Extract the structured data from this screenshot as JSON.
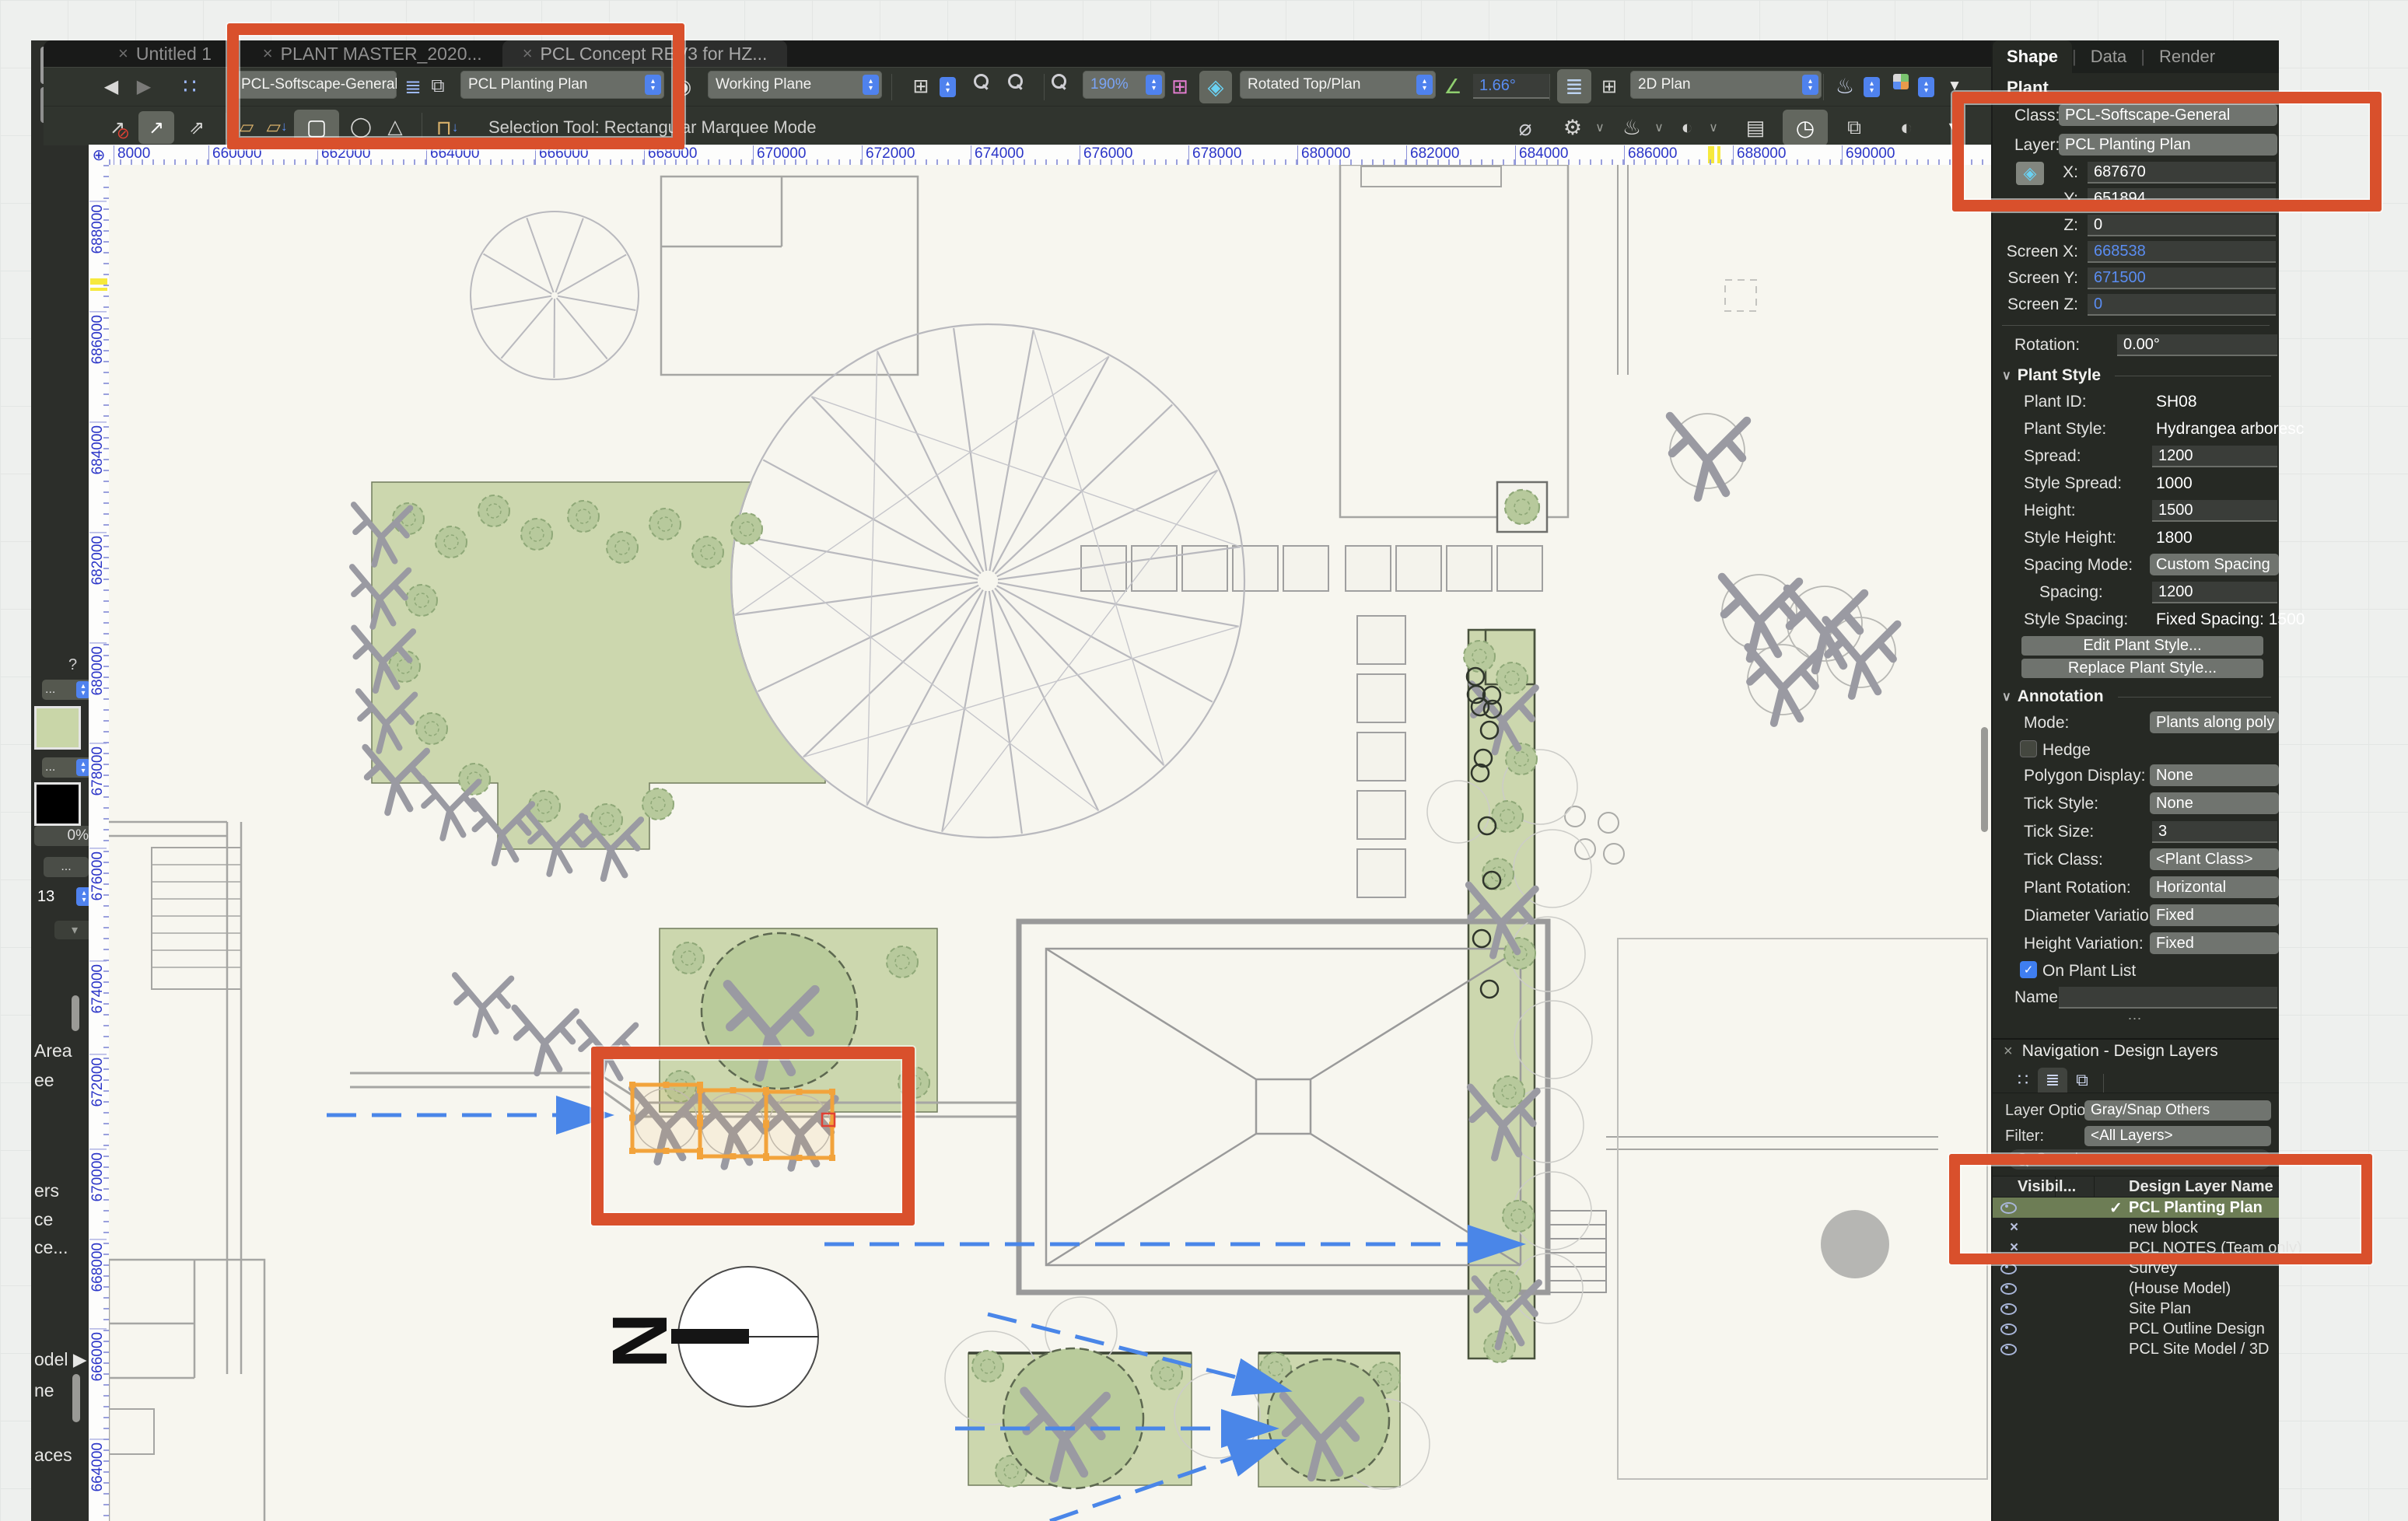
{
  "titlebar": {
    "tabs": [
      {
        "title": "Untitled 1",
        "active": false
      },
      {
        "title": "PLANT MASTER_2020...",
        "active": false
      },
      {
        "title": "PCL Concept REV3 for HZ...",
        "active": true
      }
    ]
  },
  "toolbar": {
    "class_value": "PCL-Softscape-General",
    "layer_value": "PCL Planting Plan",
    "plane_value": "Working Plane",
    "zoom_value": "190%",
    "view_value": "Rotated Top/Plan",
    "angle_value": "1.66°",
    "plan_value": "2D Plan"
  },
  "modebar": {
    "status": "Selection Tool: Rectangular Marquee Mode"
  },
  "rulers": {
    "horizontal": [
      "8000",
      "660000",
      "662000",
      "664000",
      "666000",
      "668000",
      "670000",
      "672000",
      "674000",
      "676000",
      "678000",
      "680000",
      "682000",
      "684000",
      "686000",
      "688000",
      "690000"
    ],
    "vertical": [
      "688000",
      "686000",
      "684000",
      "682000",
      "680000",
      "678000",
      "676000",
      "674000",
      "672000",
      "670000",
      "668000",
      "666000",
      "664000"
    ]
  },
  "attributes_panel": {
    "help": "?",
    "dots": "...",
    "opacity": "0%",
    "line_weight": "13",
    "flat_arrow": "▾"
  },
  "left_fragments": [
    "Area",
    "ee",
    "ers",
    "ce",
    "ce...",
    "odel ▶",
    "ne",
    "aces"
  ],
  "canvas": {
    "north_label": "N"
  },
  "object_info": {
    "tabs": [
      "Shape",
      "Data",
      "Render"
    ],
    "object_type": "Plant",
    "class_label": "Class:",
    "class_value": "PCL-Softscape-General",
    "layer_label": "Layer:",
    "layer_value": "PCL Planting Plan",
    "coord_fields": [
      {
        "label": "X:",
        "value": "687670",
        "blue": false
      },
      {
        "label": "Y:",
        "value": "651894",
        "blue": false
      },
      {
        "label": "Z:",
        "value": "0",
        "blue": false
      },
      {
        "label": "Screen X:",
        "value": "668538",
        "blue": true
      },
      {
        "label": "Screen Y:",
        "value": "671500",
        "blue": true
      },
      {
        "label": "Screen Z:",
        "value": "0",
        "blue": true
      }
    ],
    "rotation_label": "Rotation:",
    "rotation_value": "0.00°",
    "plant_style_header": "Plant Style",
    "plant_style_rows": [
      {
        "label": "Plant ID:",
        "value": "SH08",
        "type": "text"
      },
      {
        "label": "Plant Style:",
        "value": "Hydrangea arboresc",
        "type": "text"
      },
      {
        "label": "Spread:",
        "value": "1200",
        "type": "field"
      },
      {
        "label": "Style Spread:",
        "value": "1000",
        "type": "text"
      },
      {
        "label": "Height:",
        "value": "1500",
        "type": "field"
      },
      {
        "label": "Style Height:",
        "value": "1800",
        "type": "text"
      },
      {
        "label": "Spacing Mode:",
        "value": "Custom Spacing",
        "type": "dropdown"
      },
      {
        "label": "Spacing:",
        "value": "1200",
        "type": "field",
        "indent": true
      },
      {
        "label": "Style Spacing:",
        "value": "Fixed Spacing: 1500",
        "type": "text"
      }
    ],
    "buttons": [
      "Edit Plant Style...",
      "Replace Plant Style..."
    ],
    "annotation_header": "Annotation",
    "annotation_rows": [
      {
        "label": "Mode:",
        "value": "Plants along poly ed",
        "type": "dropdown"
      },
      {
        "label": "Hedge",
        "type": "check",
        "checked": false
      },
      {
        "label": "Polygon Display:",
        "value": "None",
        "type": "dropdown"
      },
      {
        "label": "Tick Style:",
        "value": "None",
        "type": "dropdown"
      },
      {
        "label": "Tick Size:",
        "value": "3",
        "type": "field"
      },
      {
        "label": "Tick Class:",
        "value": "<Plant Class>",
        "type": "dropdown"
      },
      {
        "label": "Plant Rotation:",
        "value": "Horizontal",
        "type": "dropdown"
      },
      {
        "label": "Diameter Variation:",
        "value": "Fixed",
        "type": "dropdown"
      },
      {
        "label": "Height Variation:",
        "value": "Fixed",
        "type": "dropdown"
      },
      {
        "label": "On Plant List",
        "type": "check",
        "checked": true
      }
    ],
    "name_label": "Name:",
    "name_value": "",
    "more_dots": "⋯"
  },
  "navigation": {
    "title": "Navigation - Design Layers",
    "layer_options_label": "Layer Options:",
    "layer_options_value": "Gray/Snap Others",
    "filter_label": "Filter:",
    "filter_value": "<All Layers>",
    "search_placeholder": "Search",
    "columns": {
      "visibility": "Visibil...",
      "name": "Design Layer Name"
    },
    "layers": [
      {
        "name": "PCL Planting Plan",
        "vis": "eye",
        "selected": true,
        "check": true
      },
      {
        "name": "new block",
        "vis": "x",
        "selected": false,
        "check": false
      },
      {
        "name": "PCL NOTES (Team only)",
        "vis": "x",
        "selected": false,
        "check": false
      },
      {
        "name": "Survey",
        "vis": "eye",
        "selected": false,
        "check": false
      },
      {
        "name": "(House Model)",
        "vis": "eye",
        "selected": false,
        "check": false
      },
      {
        "name": "Site Plan",
        "vis": "eye",
        "selected": false,
        "check": false
      },
      {
        "name": "PCL Outline Design",
        "vis": "eye",
        "selected": false,
        "check": false
      },
      {
        "name": "PCL Site Model / 3D",
        "vis": "eye",
        "selected": false,
        "check": false
      }
    ]
  },
  "icons": {
    "back": "◀",
    "forward": "▶",
    "nodes": "∷",
    "layers-stack": "≣",
    "page-proxy": "⧉",
    "eye-doc": "◉",
    "window-panes": "⊞",
    "flyover-diamond": "◈",
    "angle-axes": "∠",
    "teapot": "♨",
    "triangle-down": "▼",
    "arrow-ne": "↗",
    "arrow-ne-double": "⇗",
    "prohibit": "⊘",
    "marquee-square": "▢",
    "lasso": "◯",
    "poly-lasso": "△",
    "bench": "⊓",
    "box-small": "▱",
    "gear": "⚙",
    "chevron": "∨",
    "diameter": "⌀",
    "ruler": "▤",
    "save-clock": "◷",
    "contrast": "◐",
    "crosshair": "⊕",
    "more": "⋯",
    "check": "✓",
    "close": "×",
    "down-arrow": "↓",
    "pen": "✎",
    "xtool": "✕"
  },
  "colors": {
    "annotation": "#d9502c",
    "selection_orange": "#f2a33b",
    "accent_blue": "#4f82ee",
    "bed_green": "#ccd7ae",
    "selected_row": "#6d7d55"
  }
}
